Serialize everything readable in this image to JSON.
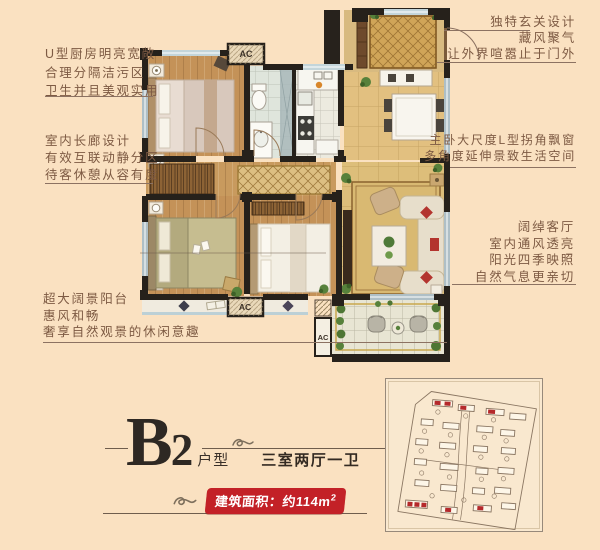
{
  "annotations": {
    "left": [
      {
        "lines": [
          "U型厨房明亮宽敞",
          "合理分隔洁污区",
          "卫生并且美观实用"
        ]
      },
      {
        "lines": [
          "室内长廊设计",
          "有效互联动静分区",
          "待客休憩从容有度"
        ]
      },
      {
        "lines": [
          "超大阔景阳台",
          "惠风和畅",
          "奢享自然观景的休闲意趣"
        ]
      }
    ],
    "right": [
      {
        "lines": [
          "独特玄关设计",
          "藏风聚气",
          "让外界喧嚣止于门外"
        ]
      },
      {
        "lines": [
          "主卧大尺度L型拐角飘窗",
          "多角度延伸景致生活空间"
        ]
      },
      {
        "lines": [
          "阔绰客厅",
          "室内通风透亮",
          "阳光四季映照",
          "自然气息更亲切"
        ]
      }
    ]
  },
  "title": {
    "plan_code_letter": "B",
    "plan_code_number": "2",
    "type_label": "户型",
    "rooms_label": "三室两厅一卫",
    "area_label": "建筑面积：约114m",
    "area_sup": "2"
  },
  "floorplan": {
    "ac_label": "AC"
  },
  "icons": {
    "flourish": "swirl-ornament"
  },
  "colors": {
    "badge_red": "#c32127",
    "annotation_text": "#7d5a43",
    "wall_black": "#26211b",
    "background": "#fae1c1"
  }
}
